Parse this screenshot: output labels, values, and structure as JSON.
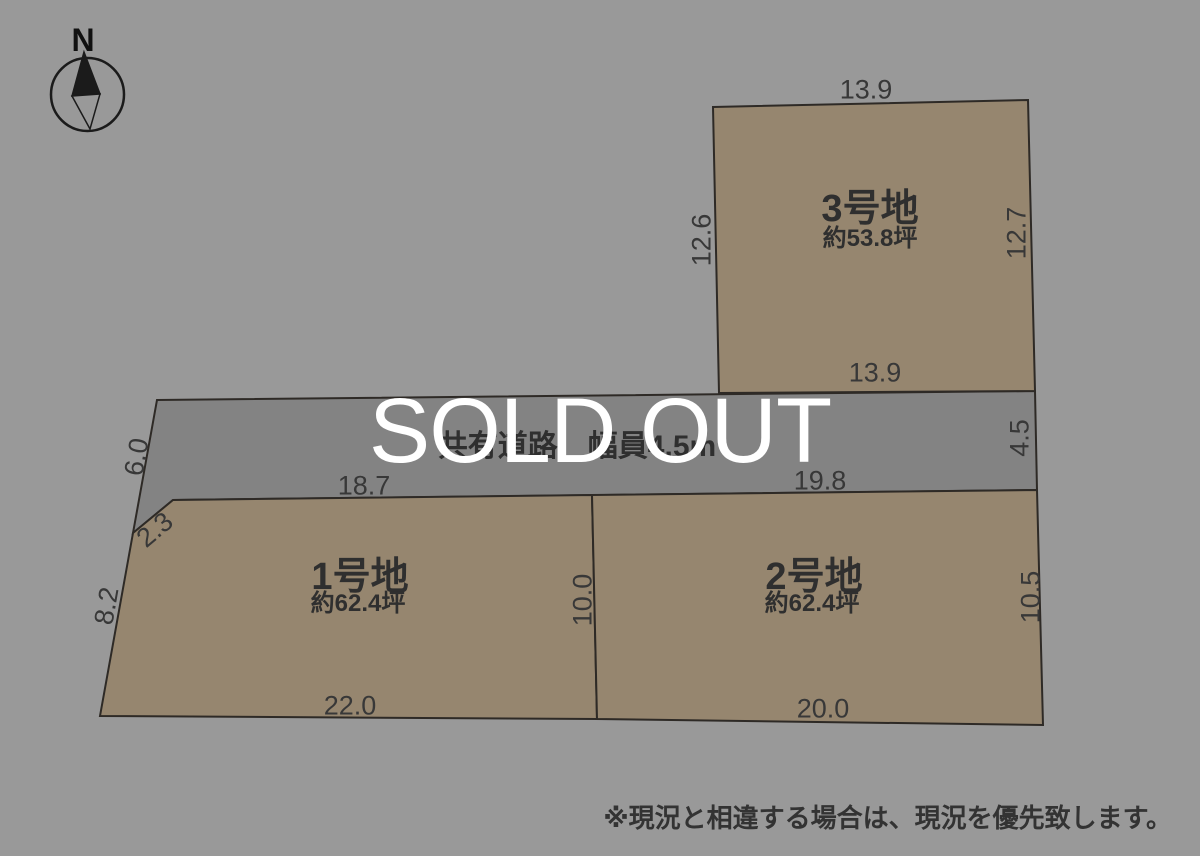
{
  "page": {
    "sold_out_label": "SOLD OUT",
    "disclaimer": "※現況と相違する場合は、現況を優先致します。"
  },
  "compass": {
    "label": "N"
  },
  "road": {
    "label": "共有道路　幅員4.5m",
    "dims": {
      "left": "6.0",
      "right": "4.5"
    }
  },
  "plots": [
    {
      "name": "1号地",
      "area": "約62.4坪",
      "dims": {
        "top": "18.7",
        "bottom": "22.0",
        "left": "8.2",
        "diagonal": "2.3",
        "right": "10.0"
      }
    },
    {
      "name": "2号地",
      "area": "約62.4坪",
      "dims": {
        "top": "19.8",
        "bottom": "20.0",
        "right": "10.5"
      }
    },
    {
      "name": "3号地",
      "area": "約53.8坪",
      "dims": {
        "top": "13.9",
        "bottom": "13.9",
        "left": "12.6",
        "right": "12.7"
      }
    }
  ],
  "colors": {
    "background": "#999999",
    "road_fill": "#838383",
    "plot_fill": "#96866F",
    "needle_fill": "#1b1b1b",
    "outline": "#2e2a26",
    "sold_out_text": "#ffffff"
  }
}
